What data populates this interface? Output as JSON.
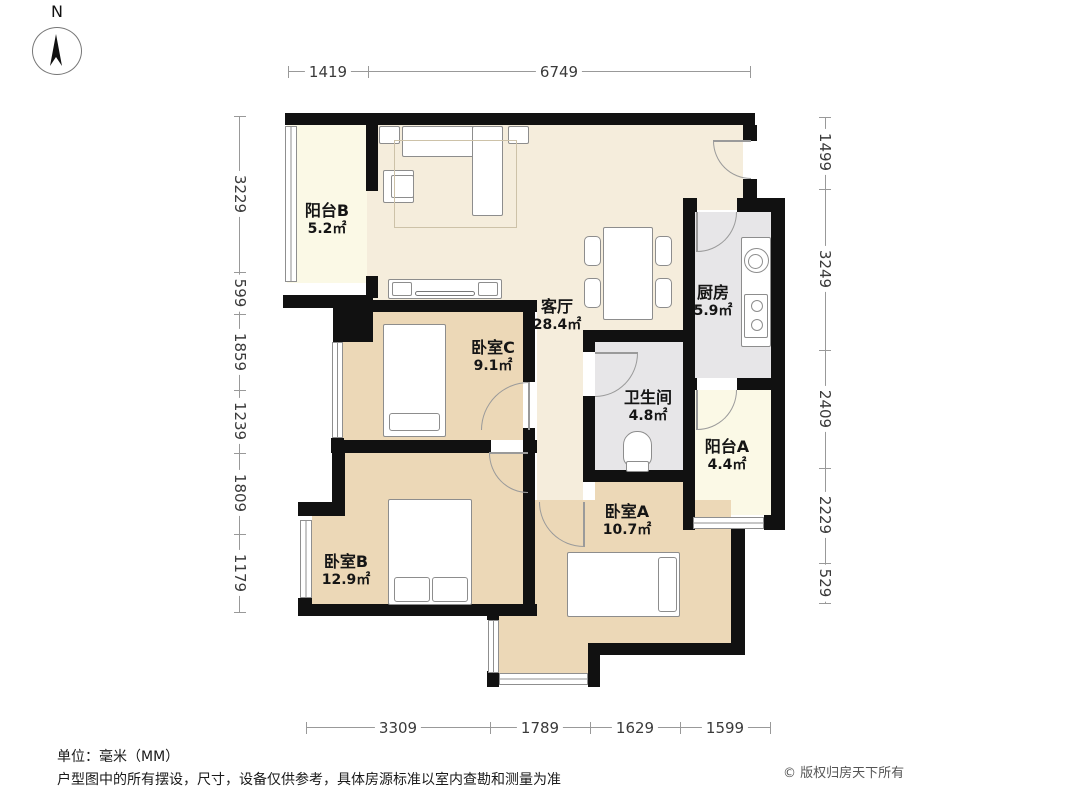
{
  "compass": {
    "label": "N"
  },
  "rooms": {
    "balcony_b": {
      "name": "阳台B",
      "area": "5.2㎡"
    },
    "living": {
      "name": "客厅",
      "area": "28.4㎡"
    },
    "kitchen": {
      "name": "厨房",
      "area": "5.9㎡"
    },
    "bathroom": {
      "name": "卫生间",
      "area": "4.8㎡"
    },
    "balcony_a": {
      "name": "阳台A",
      "area": "4.4㎡"
    },
    "bedroom_c": {
      "name": "卧室C",
      "area": "9.1㎡"
    },
    "bedroom_b": {
      "name": "卧室B",
      "area": "12.9㎡"
    },
    "bedroom_a": {
      "name": "卧室A",
      "area": "10.7㎡"
    }
  },
  "dimensions": {
    "top": [
      "1419",
      "6749"
    ],
    "left": [
      "3229",
      "599",
      "1859",
      "1239",
      "1809",
      "1179"
    ],
    "right": [
      "1499",
      "3249",
      "2409",
      "2229",
      "529"
    ],
    "bottom": [
      "3309",
      "1789",
      "1629",
      "1599"
    ]
  },
  "footer": {
    "unit_note": "单位：毫米（MM）",
    "disclaimer": "户型图中的所有摆设，尺寸，设备仅供参考，具体房源标准以室内查勘和测量为准",
    "copyright": "© 版权归房天下所有"
  },
  "colors": {
    "wall": "#111111",
    "bedroom_floor": "#ECD8B7",
    "living_floor": "#F5EDDC",
    "balcony_floor": "#FBF9E6",
    "wet_floor": "#E7E6E8"
  }
}
